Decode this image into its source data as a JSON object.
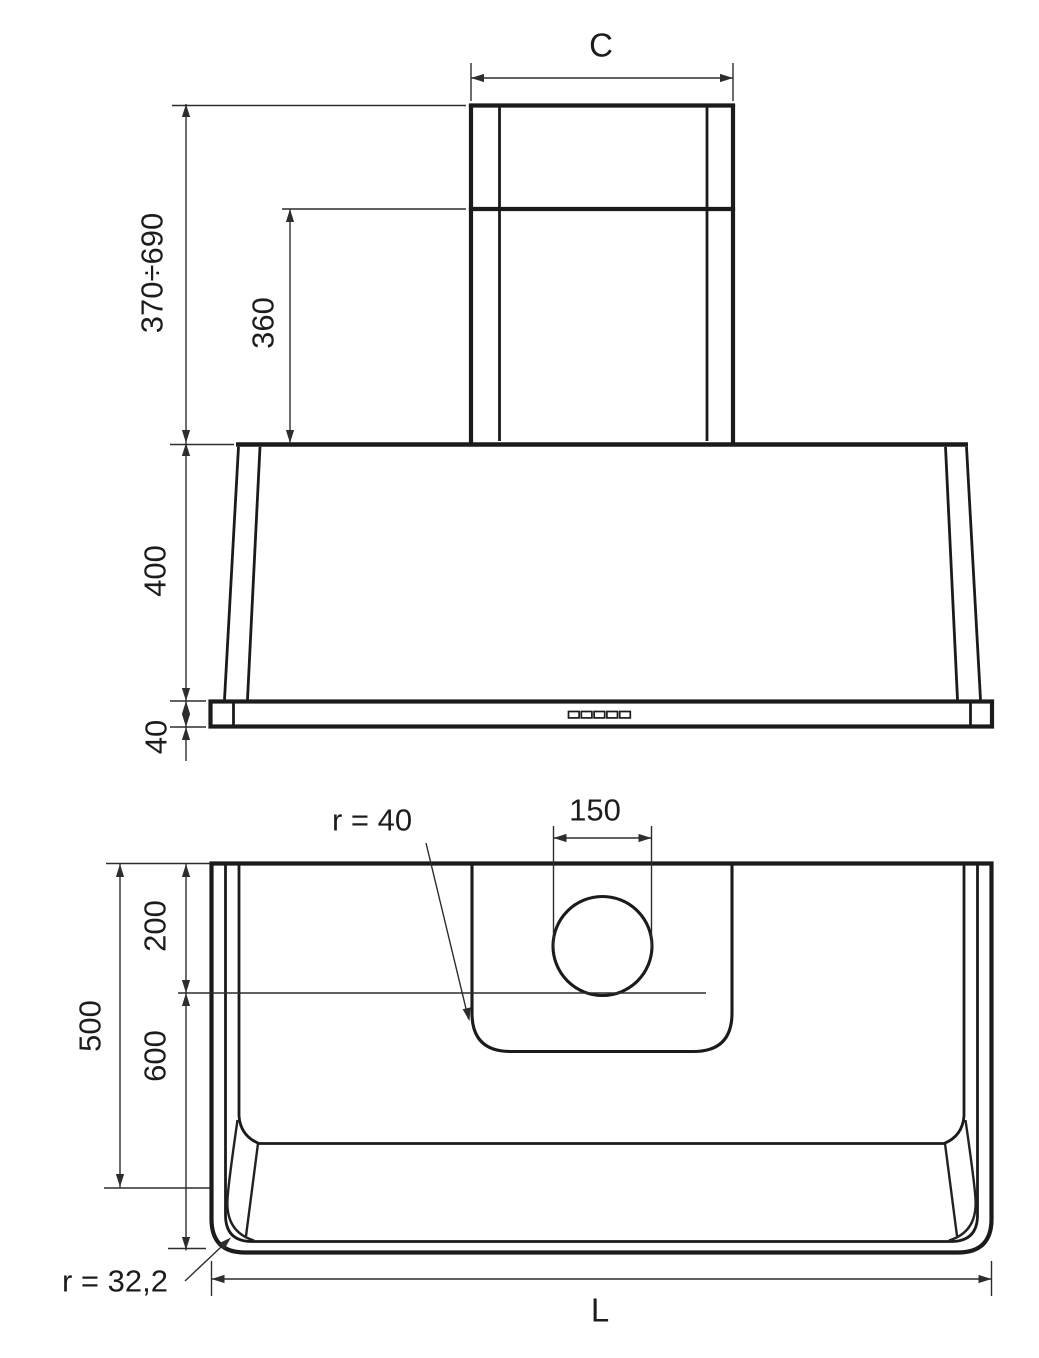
{
  "drawing": {
    "kind": "technical dimension drawing",
    "subject": "wall-mounted range hood — front elevation (top) and plan view (bottom)"
  },
  "front_view": {
    "chimney_width": "C",
    "chimney_height_range": "370÷690",
    "inner_chimney_height": "360",
    "canopy_height": "400",
    "base_frame_height": "40"
  },
  "plan_view": {
    "duct_diameter": "150",
    "recess_corner_radius": "r = 40",
    "back_depth": "200",
    "total_depth": "500",
    "front_depth": "600",
    "outer_corner_radius": "r = 32,2",
    "width_label": "L"
  },
  "colors": {
    "outline": "#1b1b1b",
    "dimension_line": "#2d2d2d",
    "text": "#1c1c1c",
    "background": "#ffffff"
  }
}
